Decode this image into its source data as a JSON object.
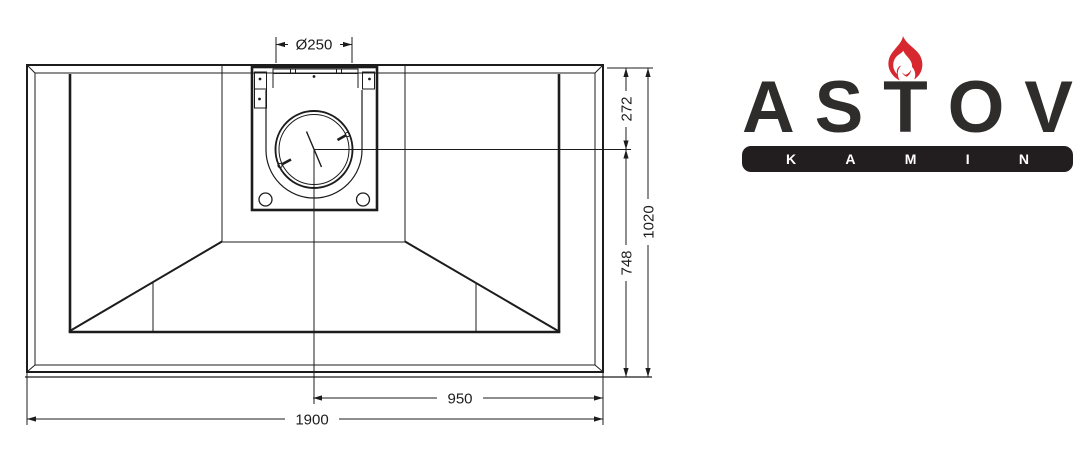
{
  "drawing": {
    "dimensions": {
      "flue_diameter": "Ø250",
      "top_offset": "272",
      "lower_height": "748",
      "total_height": "1020",
      "half_width": "950",
      "total_width": "1900"
    },
    "line_color": "#1c1c1c"
  },
  "logo": {
    "brand": "ASTOV",
    "brand_letters": [
      "A",
      "S",
      "T",
      "O",
      "V"
    ],
    "sub": "KAMIN",
    "sub_letters": [
      "K",
      "A",
      "M",
      "I",
      "N"
    ],
    "text_color": "#2e2d2c",
    "bar_color": "#221e1f",
    "flame_color": "#d7282f"
  }
}
